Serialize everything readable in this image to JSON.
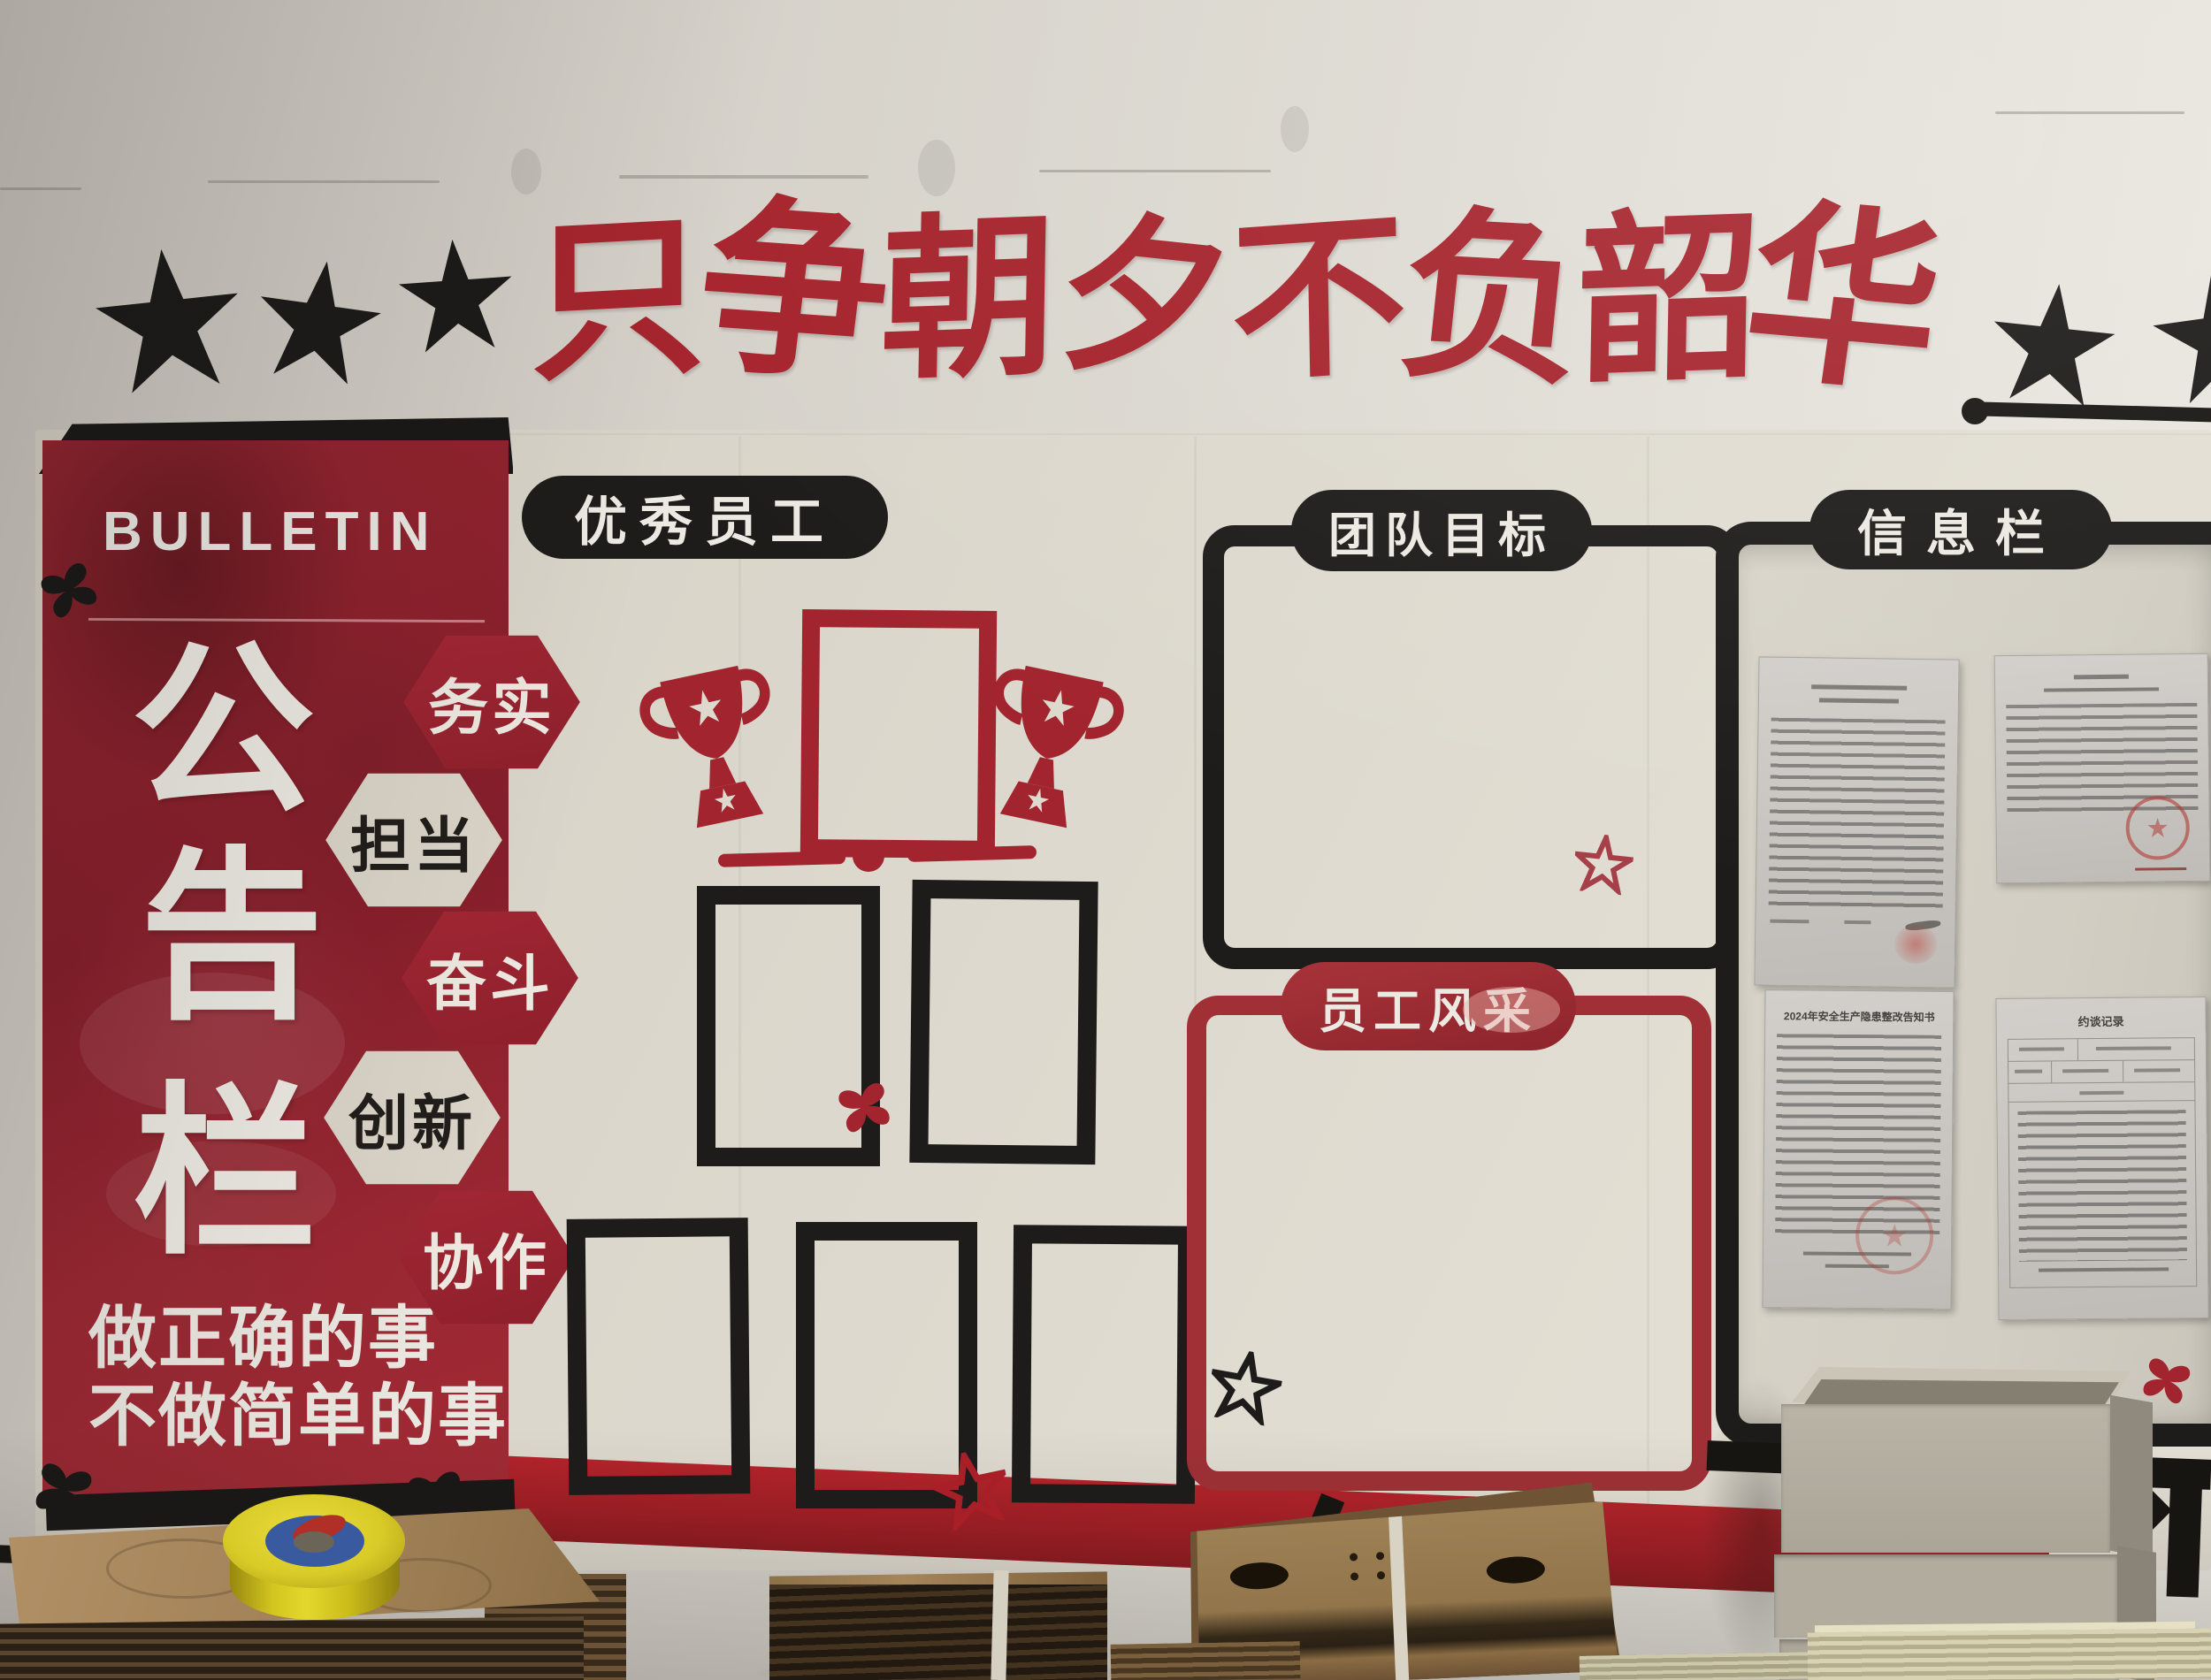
{
  "title": {
    "text": "只争朝夕不负韶华",
    "chars": [
      "只",
      "争",
      "朝",
      "夕",
      "不",
      "负",
      "韶",
      "华"
    ],
    "color": "#a6242d"
  },
  "bulletin_panel": {
    "heading": "BULLETIN",
    "vertical_chars": [
      "公",
      "告",
      "栏"
    ],
    "badges": [
      {
        "label": "务实",
        "variant": "red"
      },
      {
        "label": "担当",
        "variant": "cream"
      },
      {
        "label": "奋斗",
        "variant": "red"
      },
      {
        "label": "创新",
        "variant": "cream"
      },
      {
        "label": "协作",
        "variant": "red"
      }
    ],
    "slogan": [
      "做正确的事",
      "不做简单的事"
    ],
    "panel_color": "#8e2230"
  },
  "sections": {
    "excellent_staff": {
      "banner": "优秀员工"
    },
    "team_goals": {
      "banner": "团队目标"
    },
    "staff_style": {
      "banner": "员工风采"
    },
    "info_board": {
      "banner": "信息栏"
    }
  },
  "documents": [
    {
      "name": "notice-top-left",
      "title": ""
    },
    {
      "name": "commendation-top-right",
      "title": ""
    },
    {
      "name": "safety-notice-bottom-left",
      "title": "2024年安全生产隐患整改告知书"
    },
    {
      "name": "interview-record-bottom-right",
      "title": "约谈记录"
    }
  ],
  "decorations": {
    "star_icon": "five-point-star",
    "butterfly_icon": "butterfly",
    "trophy_icon": "trophy",
    "dot_line_icon": "dot-end-line"
  },
  "colors": {
    "accent_red": "#a6242d",
    "deep_red": "#8e2230",
    "black": "#1b1a18",
    "board_cream": "#dedacf",
    "wall": "#d8d4cc",
    "tape_yellow": "#d8ca28",
    "cardboard": "#8a6b4a",
    "box_gray": "#b5afa2"
  }
}
